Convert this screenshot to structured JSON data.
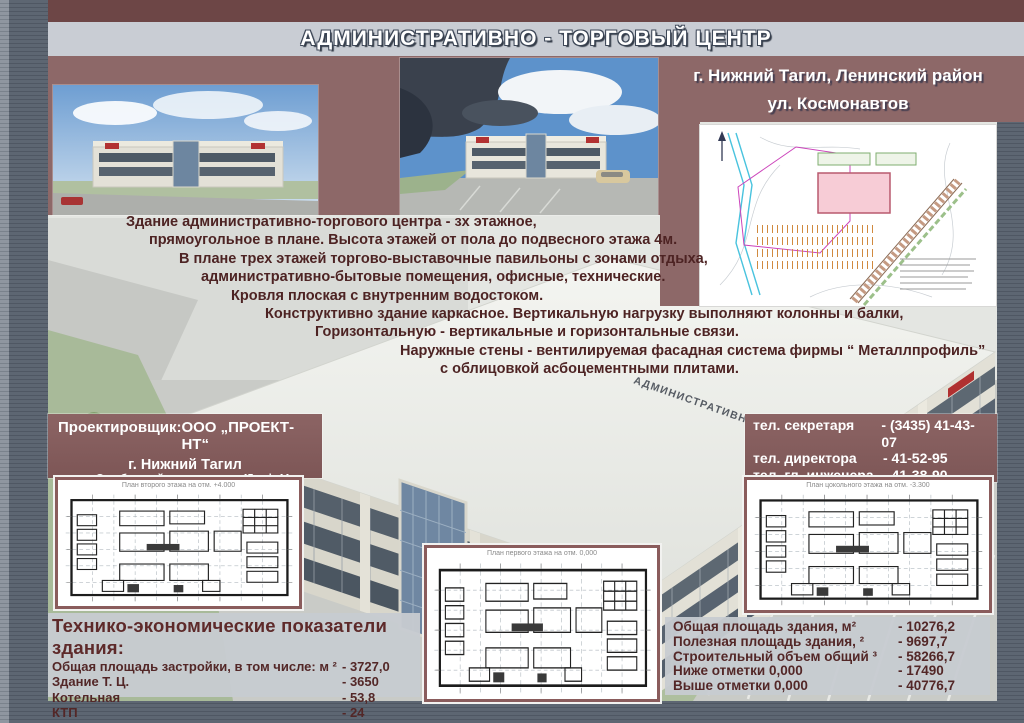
{
  "header": {
    "title": "АДМИНИСТРАТИВНО - ТОРГОВЫЙ ЦЕНТР",
    "location_line1": "г. Нижний Тагил, Ленинский район",
    "location_line2": "ул. Космонавтов"
  },
  "description": {
    "lines": [
      "Здание административно-торгового центра - зх этажное,",
      "прямоугольное в плане. Высота этажей от пола до подвесного этажа 4м.",
      "В плане трех этажей торгово-выставочные павильоны с зонами отдыха,",
      "административно-бытовые помещения, офисные, технические.",
      "Кровля плоская с внутренним водостоком.",
      "Конструктивно здание каркасное. Вертикальную нагрузку выполняют колонны и балки,",
      "Горизонтальную - вертикальные и горизонтальные связи.",
      "Наружные стены - вентилируемая фасадная система фирмы “ Металлпрофиль”",
      "с облицовкой асбоцементными плитами."
    ]
  },
  "building_render": {
    "roof_label": "АДМИНИСТРАТИВНО-ТОРГОВЫЙ ЦЕНТР"
  },
  "designer": {
    "label": "Проектировщик:",
    "company": "ООО „ПРОЕКТ-НТ“",
    "city": "г. Нижний Тагил",
    "address": "ул.Октябрьской революции, д.45, оф.44",
    "phone": "тел. (3435) 41-52-95"
  },
  "contacts": {
    "rows": [
      {
        "label": "тел. секретаря",
        "value": "- (3435) 41-43-07"
      },
      {
        "label": "тел. директора",
        "value": "- 41-52-95"
      },
      {
        "label": "тел. гл. инженера",
        "value": "- 41-38-90"
      },
      {
        "label": "E - mail:",
        "value": "tkpnt@mail.ru"
      }
    ]
  },
  "plans": [
    {
      "title": "План второго этажа на отм. +4.000"
    },
    {
      "title": "План первого этажа на отм. 0,000"
    },
    {
      "title": "План цокольного этажа на отм. -3.300"
    }
  ],
  "indicators": {
    "heading": "Технико-экономические показатели здания:",
    "rows": [
      {
        "label": "Общая площадь застройки, в том числе: м ²",
        "value": "- 3727,0"
      },
      {
        "label": "Здание Т. Ц.",
        "value": "- 3650"
      },
      {
        "label": "Котельная",
        "value": "- 53,8"
      },
      {
        "label": "КТП",
        "value": "- 24"
      }
    ]
  },
  "areas": {
    "rows": [
      {
        "label": "Общая площадь здания, м²",
        "value": "- 10276,2"
      },
      {
        "label": "Полезная площадь здания, ²",
        "value": "- 9697,7"
      },
      {
        "label": "Строительный объем общий ³",
        "value": "- 58266,7"
      },
      {
        "label": "Ниже отметки 0,000",
        "value": "- 17490"
      },
      {
        "label": "Выше отметки 0,000",
        "value": "- 40776,7"
      }
    ]
  },
  "colors": {
    "maroon_band": "#8d6868",
    "maroon_dark": "#6d4646",
    "title_panel": "#c9cdd4",
    "info_panel": "#c7cbd1",
    "text_maroon": "#4d2323",
    "plan_border": "#8a5c5c",
    "siteplan_building": "#f7ccd6"
  }
}
